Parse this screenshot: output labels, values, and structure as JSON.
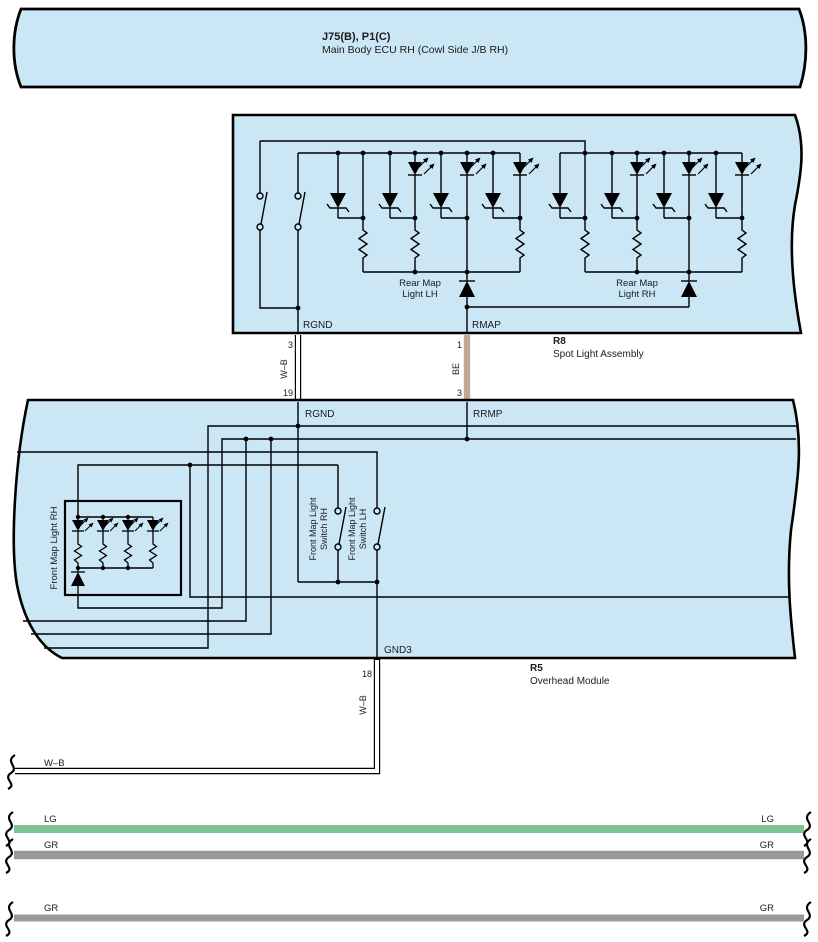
{
  "top_band": {
    "title": "J75(B), P1(C)",
    "subtitle": "Main Body ECU RH (Cowl Side J/B RH)"
  },
  "r8": {
    "code": "R8",
    "name": "Spot Light Assembly",
    "pin_rgnd": "RGND",
    "pin_rmap": "RMAP",
    "lamp_lh_line1": "Rear Map",
    "lamp_lh_line2": "Light LH",
    "lamp_rh_line1": "Rear Map",
    "lamp_rh_line2": "Light RH"
  },
  "r5": {
    "code": "R5",
    "name": "Overhead Module",
    "pin_rgnd": "RGND",
    "pin_rrmp": "RRMP",
    "pin_gnd3": "GND3",
    "front_map_light": "Front Map Light RH",
    "switch_rh_line1": "Front Map Light",
    "switch_rh_line2": "Switch RH",
    "switch_lh_line1": "Front Map Light",
    "switch_lh_line2": "Switch LH"
  },
  "wire_rgnd": {
    "top_pin": "3",
    "color": "W–B",
    "bottom_pin": "19"
  },
  "wire_rmap": {
    "top_pin": "1",
    "color": "BE",
    "bottom_pin": "3"
  },
  "wire_gnd3": {
    "pin": "18",
    "color": "W–B"
  },
  "wire_wb_left": {
    "label": "W–B"
  },
  "bands": {
    "lg_left": "LG",
    "lg_right": "LG",
    "gr_left": "GR",
    "gr_right": "GR",
    "gr2_left": "GR",
    "gr2_right": "GR"
  },
  "colors": {
    "box_fill": "#cbe7f5",
    "wire_be": "#c2a994",
    "band_lg": "#7dc591",
    "band_gr": "#98999b"
  }
}
